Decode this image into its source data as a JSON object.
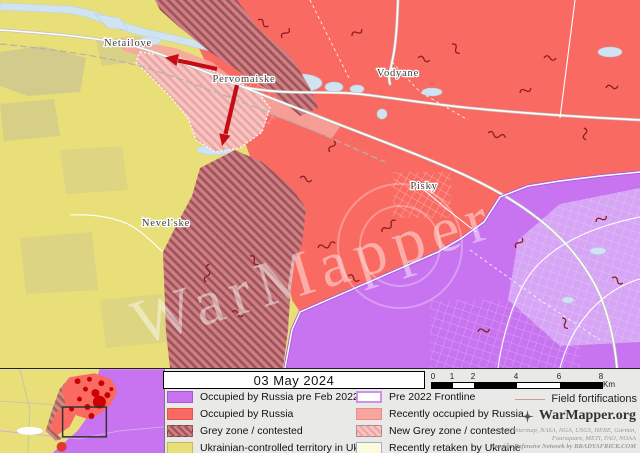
{
  "header": {
    "date": "03 May 2024"
  },
  "map": {
    "labels": [
      {
        "name": "Netailove"
      },
      {
        "name": "Pervomaiske"
      },
      {
        "name": "Vodyane"
      },
      {
        "name": "Pisky"
      },
      {
        "name": "Nevel'ske"
      }
    ],
    "watermark": "WarMapper"
  },
  "legend": {
    "left": [
      {
        "label": "Occupied by Russia pre Feb 2022"
      },
      {
        "label": "Occupied by Russia"
      },
      {
        "label": "Grey zone / contested"
      },
      {
        "label": "Ukrainian-controlled territory in Ukraine"
      }
    ],
    "right": [
      {
        "label": "Pre 2022 Frontline"
      },
      {
        "label": "Recently occupied by Russia"
      },
      {
        "label": "New Grey zone / contested"
      },
      {
        "label": "Recently retaken by Ukraine"
      }
    ],
    "fortifications_label": "Field fortifications"
  },
  "scalebar": {
    "ticks": [
      "0",
      "1",
      "2",
      "4",
      "6",
      "8"
    ],
    "unit": "Km"
  },
  "branding": {
    "site": "WarMapper.org",
    "credits1": "Esri, Intermap, NASA, NGA, USGS, HERE, Garmin,",
    "credits2": "Foursquare, METI, FAO, NOAA",
    "credits3": "Russian Defensive Network by BRADYAFRICK.COM"
  },
  "colors": {
    "pre2022": "#c873ef",
    "occupied": "#f96a62",
    "ukraine": "#e8df79",
    "recent_occupied": "#f8a5a0",
    "retaken": "#fdfbdc",
    "water": "#cfe3f1",
    "fortification": "#8c1c22",
    "arrow": "#c40d12",
    "panel_bg": "#e9e9e7"
  }
}
